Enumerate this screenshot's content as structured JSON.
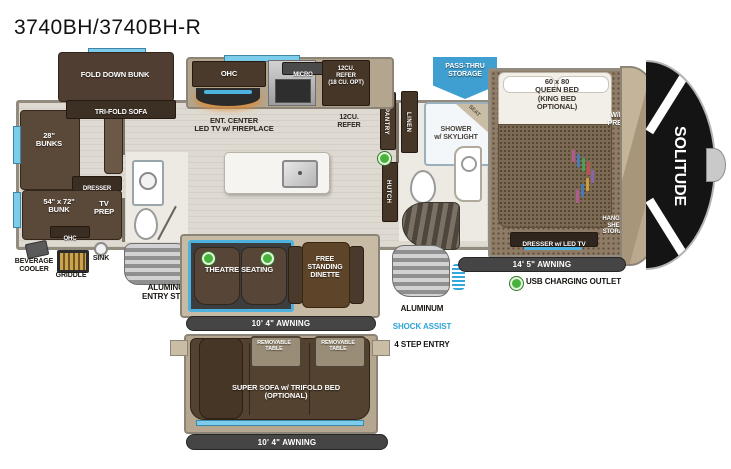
{
  "title": "3740BH/3740BH-R",
  "brand": "SOLITUDE",
  "colors": {
    "accent_blue": "#3f9fd0",
    "trim_blue": "#4db2de",
    "awning_bar": "#454545",
    "usb_green": "#47b33a",
    "furniture_brown": "#5a4838",
    "floor_wood": "#dcd8cf",
    "carpet_brown": "#8f7c66"
  },
  "bunkhouse": {
    "fold_down_bunk": "FOLD DOWN BUNK",
    "tri_fold_sofa": "TRI-FOLD SOFA",
    "bunks_28": "28\"\nBUNKS",
    "dresser": "DRESSER",
    "bunk_54x72": "54\" x 72\"\nBUNK",
    "tv_prep": "TV\nPREP",
    "ohc": "OHC"
  },
  "exterior_kitchen": {
    "beverage_cooler": "BEVERAGE\nCOOLER",
    "griddle": "GRIDDLE",
    "sink": "SINK"
  },
  "kitchen": {
    "ohc": "OHC",
    "micro": "MICRO",
    "refer_upper": "12CU.\nREFER\n(18 CU. OPT)",
    "ent_center": "ENT. CENTER\nLED TV w/ FIREPLACE",
    "refer": "12CU.\nREFER",
    "pantry": "PANTRY",
    "linen": "LINEN",
    "hutch": "HUTCH"
  },
  "bath": {
    "shower": "SHOWER\nw/ SKYLIGHT",
    "seat": "SEAT"
  },
  "bedroom": {
    "queen_bed": "60 x 80\nQUEEN BED\n(KING BED\nOPTIONAL)",
    "wd_prep": "W/D\nPREP",
    "dresser_led_tv": "DRESSER w/ LED TV",
    "hanging_shelf": "HANGING/\nSHELF\nSTORAGE"
  },
  "storage": {
    "pass_thru": "PASS-THRU\nSTORAGE"
  },
  "living": {
    "theatre_seating": "THEATRE SEATING",
    "dinette": "FREE\nSTANDING\nDINETTE"
  },
  "steps": {
    "entry_steps": "ALUMINUM\nENTRY STEPS",
    "shock_line1": "ALUMINUM",
    "shock_line2": "SHOCK ASSIST",
    "shock_line3": "4 STEP ENTRY"
  },
  "awnings": {
    "living": "10' 4\" AWNING",
    "door_side": "14' 5\" AWNING",
    "optional": "10' 4\" AWNING"
  },
  "legend": {
    "usb": "USB CHARGING OUTLET"
  },
  "optional_layout": {
    "removable_table_1": "REMOVABLE\nTABLE",
    "removable_table_2": "REMOVABLE\nTABLE",
    "super_sofa": "SUPER SOFA w/ TRIFOLD BED\n(OPTIONAL)"
  }
}
